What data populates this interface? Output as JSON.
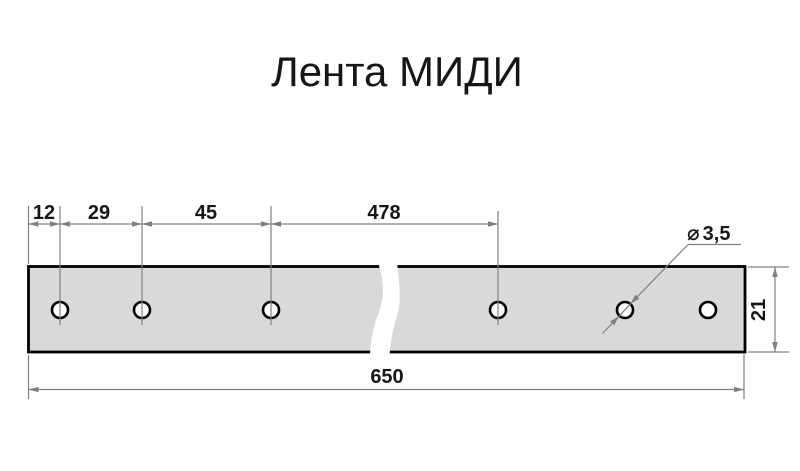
{
  "title": "Лента МИДИ",
  "dimensions": {
    "d12": "12",
    "d29": "29",
    "d45": "45",
    "d478": "478",
    "d650": "650",
    "d21": "21",
    "dia_symbol": "⌀",
    "dia_value": "3,5"
  },
  "part": {
    "hole_count": 6
  },
  "colors": {
    "line_gray": "#808080",
    "strip_fill": "#d9d9d9",
    "outline_black": "#000000",
    "text": "#161616",
    "background": "#ffffff"
  }
}
